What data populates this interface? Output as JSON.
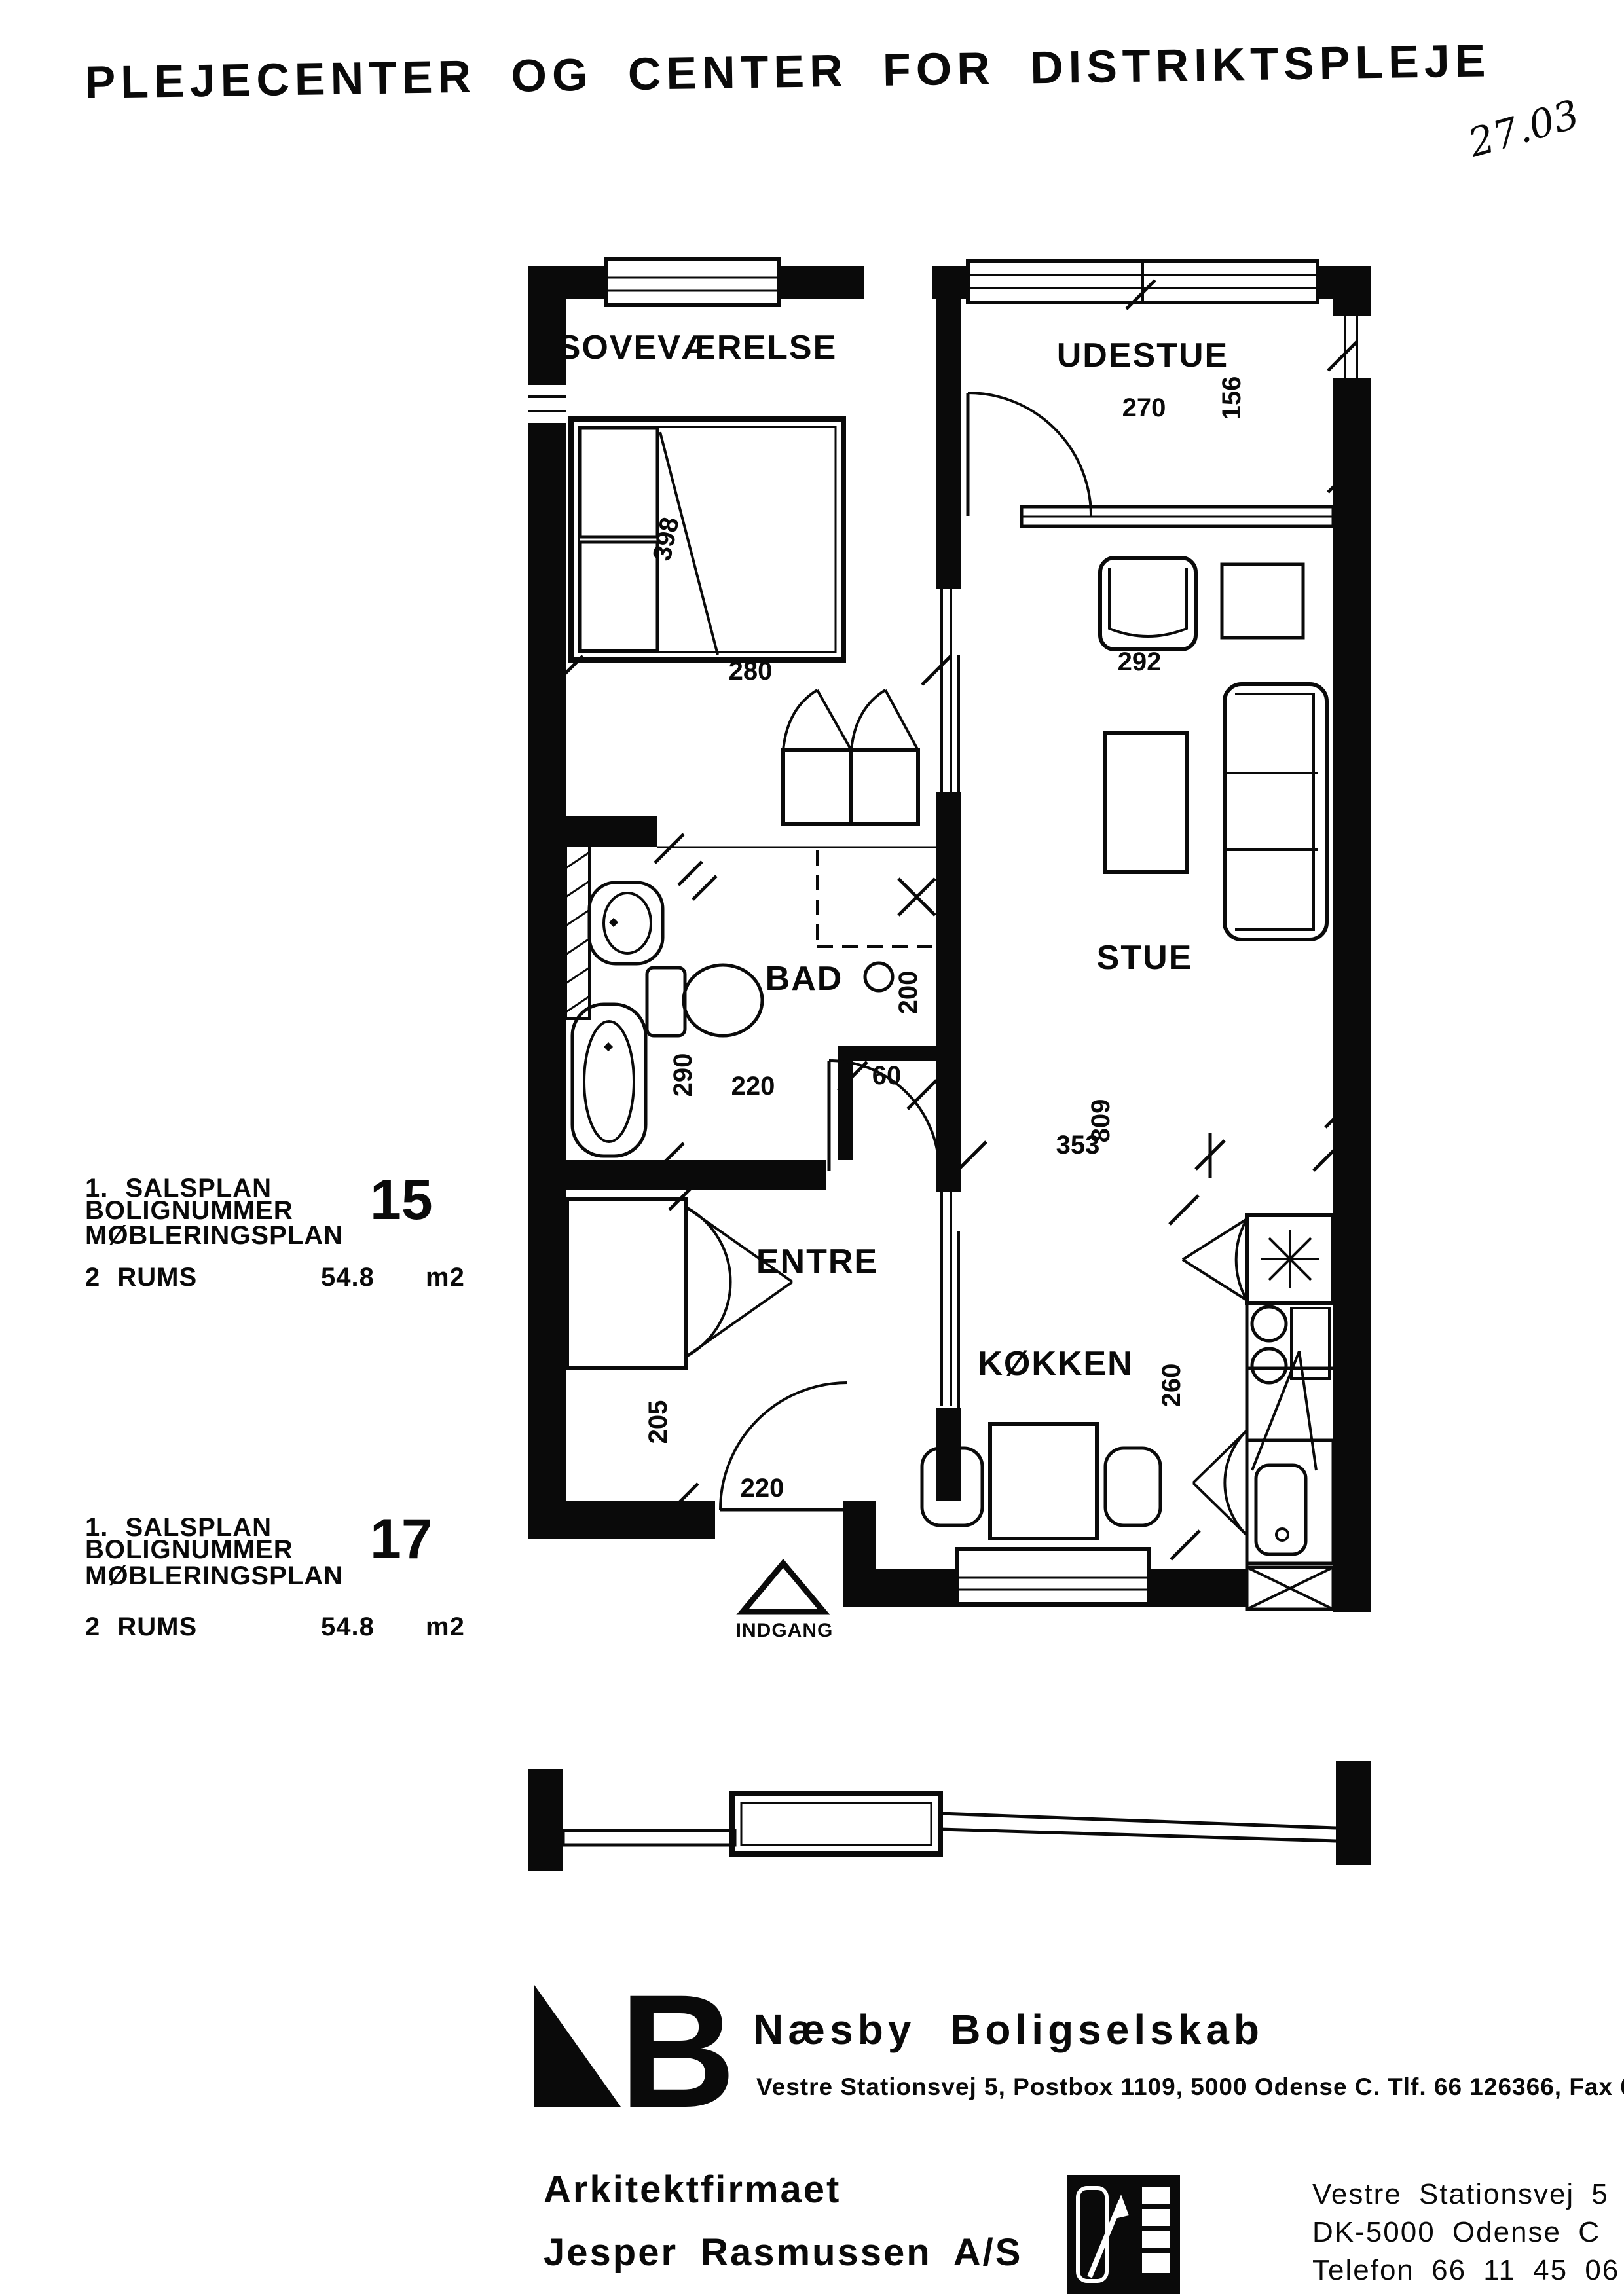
{
  "title": "PLEJECENTER OG CENTER FOR DISTRIKTSPLEJE",
  "handwritten_note": "27.03",
  "plan": {
    "rooms": {
      "sovevaerelse": "SOVEVÆRELSE",
      "udestue": "UDESTUE",
      "bad": "BAD",
      "stue": "STUE",
      "entre": "ENTRE",
      "kokken": "KØKKEN"
    },
    "entrance_label": "INDGANG",
    "dims": {
      "bed_length": "398",
      "bed_width": "280",
      "udestue_width": "270",
      "udestue_depth": "156",
      "stue_bay_width": "292",
      "bad_depth": "290",
      "bad_width": "220",
      "shower_width": "200",
      "niche_width": "60",
      "stue_length": "809",
      "kokken_width": "353",
      "kokken_depth": "260",
      "entre_depth": "205",
      "entre_width": "220"
    }
  },
  "info_blocks": [
    {
      "floor_line": "1. SALSPLAN",
      "number_label": "BOLIGNUMMER",
      "number": "15",
      "plan_line": "MØBLERINGSPLAN",
      "rooms_line": "2 RUMS",
      "area": "54.8",
      "area_unit": "m2"
    },
    {
      "floor_line": "1. SALSPLAN",
      "number_label": "BOLIGNUMMER",
      "number": "17",
      "plan_line": "MØBLERINGSPLAN",
      "rooms_line": "2 RUMS",
      "area": "54.8",
      "area_unit": "m2"
    }
  ],
  "footer": {
    "company_name": "Næsby Boligselskab",
    "company_address": "Vestre Stationsvej 5, Postbox 1109, 5000 Odense C. Tlf. 66 126366, Fax 66 129066",
    "architect_line1": "Arkitektfirmaet",
    "architect_line2": "Jesper Rasmussen A/S",
    "architect_address1": "Vestre Stationsvej 5",
    "architect_address2": "DK-5000 Odense C",
    "architect_address3": "Telefon 66 11 45 06"
  }
}
